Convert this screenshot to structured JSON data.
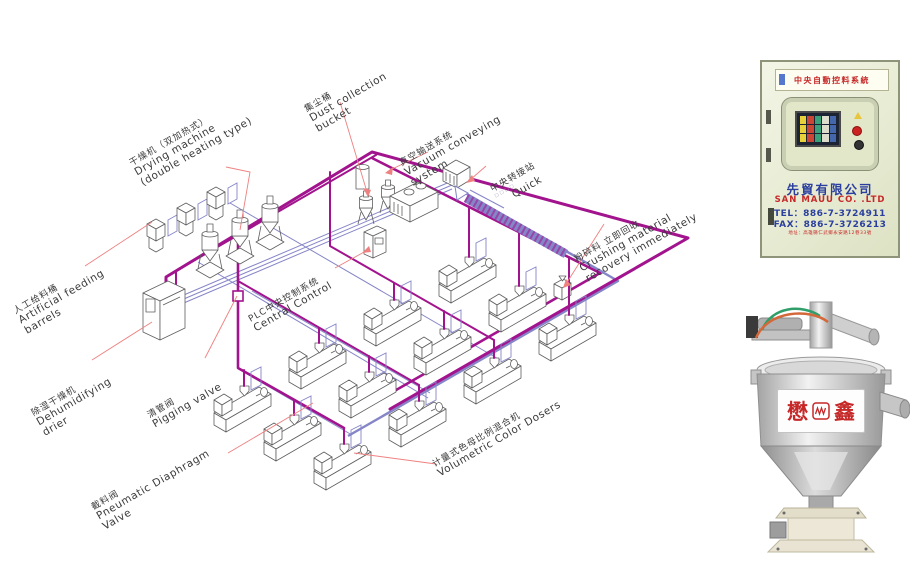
{
  "colors": {
    "pipe_magenta": "#a2138e",
    "pipe_blue": "#8585c8",
    "leader_red": "#ef8080",
    "outline_gray": "#5f5f5f",
    "label_text": "#3a3a3a",
    "cab_body": "#e9edd6",
    "cab_border": "#8e9479",
    "brand_red": "#c62828",
    "brand_blue": "#2b3f9e"
  },
  "diagram": {
    "labels": {
      "drying": {
        "zh": "干燥机（双加热式）",
        "en1": "Drying machine",
        "en2": "(double heating type)"
      },
      "dust": {
        "zh": "集尘桶",
        "en1": "Dust collection",
        "en2": "bucket"
      },
      "vacuum": {
        "zh": "真空输送系统",
        "en1": "Vacuum conveying",
        "en2": "system"
      },
      "transfer": {
        "zh": "中央转接站",
        "sub": "□□□□",
        "en1": "Quick"
      },
      "feeding": {
        "zh": "人工给料桶",
        "en1": "Artificial feeding",
        "en2": "barrels"
      },
      "dehumidifying": {
        "zh": "除湿干燥机",
        "en1": "Dehumidifying",
        "en2": "drier"
      },
      "pigging": {
        "zh": "清管阀",
        "en1": "Pigging valve"
      },
      "plc": {
        "zh": "PLC中央控制系统",
        "en1": "Central Control"
      },
      "crushing": {
        "zh": "粉碎料 立即回收",
        "en1": "Crushing material",
        "en2": "recovery immediately"
      },
      "diaphragm": {
        "zh": "截料阀",
        "en1": "Pneumatic Diaphragm",
        "en2": "Valve"
      },
      "doser": {
        "zh": "计量式色母比例混合机",
        "en1": "Volumetric Color Dosers"
      }
    }
  },
  "cabinet_photo": {
    "sign": "中央自動控料系統",
    "company_zh": "先貿有限公司",
    "company_en": "SAN MAUU CO. .LTD",
    "tel": "TEL：886-7-3724911",
    "fax": "FAX：886-7-3726213",
    "address": "地址：高雄縣仁武鄉永安路12巷33號"
  },
  "hopper_photo": {
    "brand_left": "懋",
    "brand_right": "鑫"
  }
}
